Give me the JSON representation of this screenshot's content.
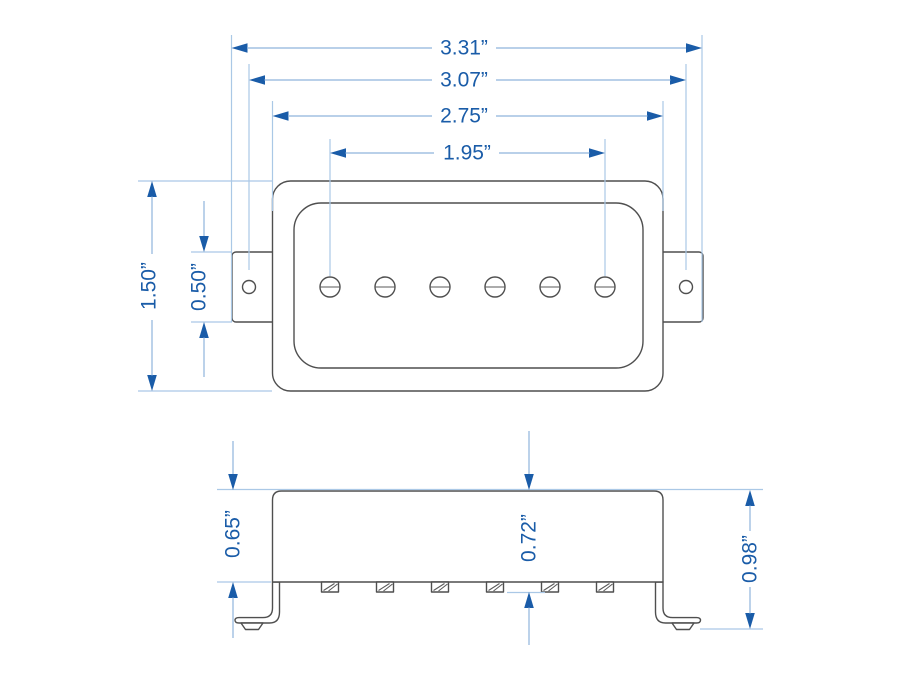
{
  "drawing": {
    "subject": "guitar pickup dimension drawing, top view and side view",
    "unit": "inches",
    "colors": {
      "dimension_blue": "#1a5ca8",
      "dimension_line_blue": "#8fb4dc",
      "extension_line_blue": "#aac8e6",
      "outline_gray": "#4f4f4f",
      "background": "#ffffff"
    },
    "top_view": {
      "pole_piece_count": 6,
      "mounting_hole_count": 2,
      "dims": {
        "d331": {
          "label": "3.31”",
          "inches": 3.31
        },
        "d307": {
          "label": "3.07”",
          "inches": 3.07
        },
        "d275": {
          "label": "2.75”",
          "inches": 2.75
        },
        "d195": {
          "label": "1.95”",
          "inches": 1.95
        },
        "d150": {
          "label": "1.50”",
          "inches": 1.5
        },
        "d050": {
          "label": "0.50”",
          "inches": 0.5
        }
      }
    },
    "side_view": {
      "pole_screw_tip_count": 6,
      "mounting_leg_count": 2,
      "dims": {
        "d065": {
          "label": "0.65”",
          "inches": 0.65
        },
        "d072": {
          "label": "0.72”",
          "inches": 0.72
        },
        "d098": {
          "label": "0.98”",
          "inches": 0.98
        }
      }
    }
  }
}
